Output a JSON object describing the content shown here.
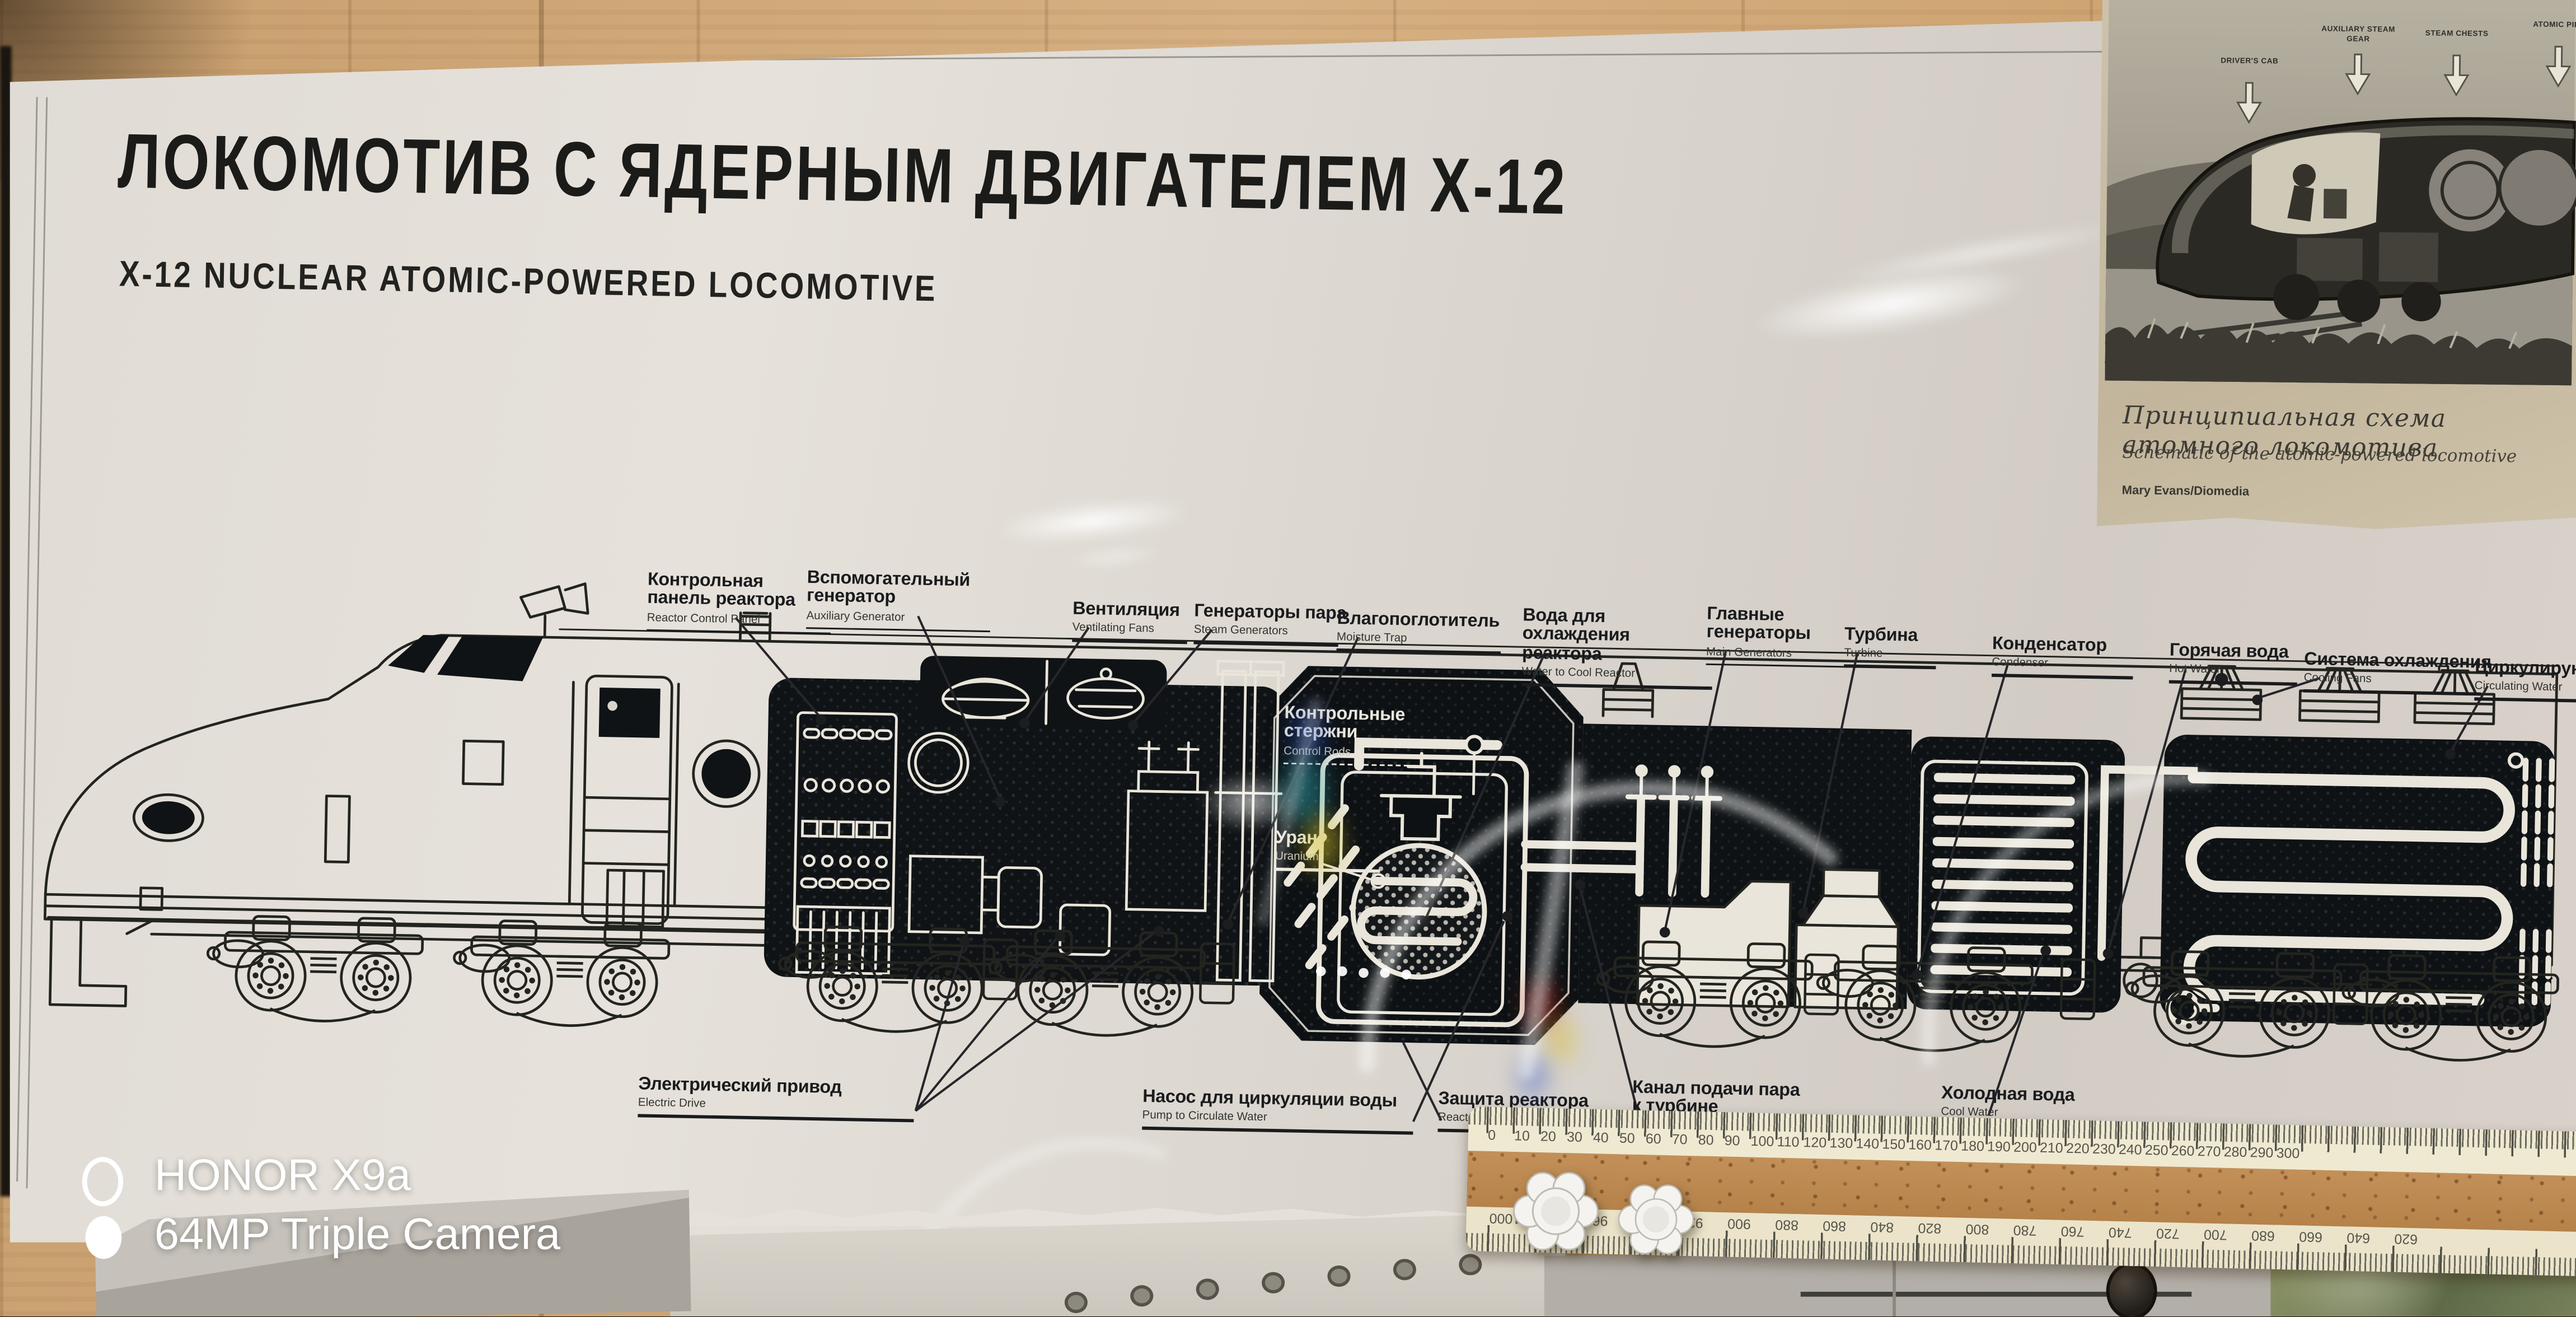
{
  "colors": {
    "wood_wall": "#cfa573",
    "poster_paper": "#dfdbd4",
    "ink": "#1b1b19",
    "panel_black": "#0e1214",
    "diagram_cream": "#e9e5da",
    "sepia_paper": "#c8bca4",
    "ruler_cream": "#efe9d2",
    "ruler_wood": "#bb8a55"
  },
  "main_poster": {
    "title_ru": "ЛОКОМОТИВ С ЯДЕРНЫМ ДВИГАТЕЛЕМ Х-12",
    "title_en": "X-12 NUCLEAR ATOMIC-POWERED LOCOMOTIVE",
    "labels_top": [
      {
        "ru": "Контрольная панель реактора",
        "en": "Reactor Control Panel"
      },
      {
        "ru": "Вспомогательный генератор",
        "en": "Auxiliary Generator"
      },
      {
        "ru": "Вентиляция",
        "en": "Ventilating Fans"
      },
      {
        "ru": "Генераторы пара",
        "en": "Steam Generators"
      },
      {
        "ru": "Влагопоглотитель",
        "en": "Moisture Trap"
      },
      {
        "ru": "Вода для охлаждения реактора",
        "en": "Water to Cool Reactor"
      },
      {
        "ru": "Главные генераторы",
        "en": "Main Generators"
      },
      {
        "ru": "Турбина",
        "en": "Turbine"
      },
      {
        "ru": "Конденсатор",
        "en": "Condenser"
      },
      {
        "ru": "Горячая вода",
        "en": "Hot Water"
      },
      {
        "ru": "Система охлаждения",
        "en": "Cooling Fans"
      },
      {
        "ru": "Циркулирующая вода",
        "en": "Circulating Water"
      }
    ],
    "labels_bottom": [
      {
        "ru": "Электрический привод",
        "en": "Electric Drive"
      },
      {
        "ru": "Насос для циркуляции воды",
        "en": "Pump to Circulate Water"
      },
      {
        "ru": "Защита реактора",
        "en": "Reactor Shield"
      },
      {
        "ru": "Канал подачи пара к турбине",
        "en": "Steam to Turbine"
      },
      {
        "ru": "Холодная вода",
        "en": "Cool Water"
      }
    ],
    "labels_reactor": [
      {
        "ru": "Контрольные стержни",
        "en": "Control Rods"
      },
      {
        "ru": "Уран",
        "en": "Uranium"
      }
    ]
  },
  "side_poster": {
    "caption_ru": "Принципиальная схема атомного локомотива",
    "caption_en": "Schematic of the atomic-powered locomotive",
    "credit": "Mary Evans/Diomedia",
    "part_labels": [
      "DRIVER'S CAB",
      "AUXILIARY STEAM GEAR",
      "STEAM CHESTS",
      "ATOMIC PILE"
    ]
  },
  "camera_watermark": {
    "line1": "HONOR X9a",
    "line2": "64MP Triple Camera"
  },
  "ruler": {
    "top_numbers": [
      "0",
      "10",
      "20",
      "30",
      "40",
      "50",
      "60",
      "70",
      "80",
      "90",
      "100",
      "110",
      "120",
      "130",
      "140",
      "150",
      "160",
      "170",
      "180",
      "190",
      "200",
      "210",
      "220",
      "230",
      "240",
      "250",
      "260",
      "270",
      "280",
      "290",
      "300"
    ],
    "bottom_numbers": [
      "1000",
      "980",
      "960",
      "940",
      "920",
      "900",
      "880",
      "860",
      "840",
      "820",
      "800",
      "780",
      "760",
      "740",
      "720",
      "700",
      "680",
      "660",
      "640",
      "620"
    ]
  }
}
